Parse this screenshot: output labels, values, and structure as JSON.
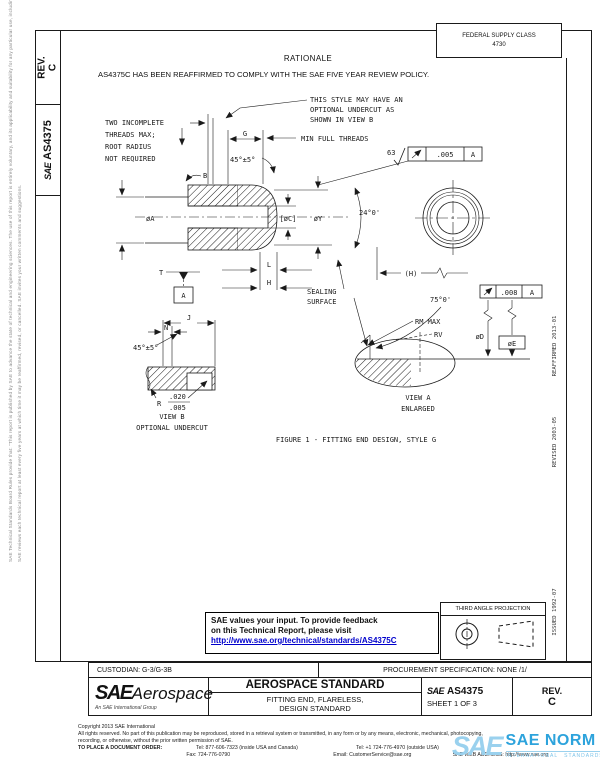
{
  "header": {
    "rev_label": "REV.",
    "rev_value": "C",
    "doc_logo": "SAE",
    "doc_number": "AS4375",
    "fsc_line1": "FEDERAL SUPPLY CLASS",
    "fsc_line2": "4730"
  },
  "rationale": {
    "title": "RATIONALE",
    "body": "AS4375C HAS BEEN REAFFIRMED TO COMPLY WITH THE SAE FIVE YEAR REVIEW POLICY."
  },
  "drawing": {
    "caption": "FIGURE 1 - FITTING END DESIGN, STYLE G",
    "note_style": [
      "THIS STYLE MAY HAVE AN",
      "OPTIONAL UNDERCUT AS",
      "SHOWN IN VIEW B"
    ],
    "note_threads": [
      "TWO INCOMPLETE",
      "THREADS MAX;",
      "ROOT RADIUS",
      "NOT REQUIRED"
    ],
    "sealing": [
      "SEALING",
      "SURFACE"
    ],
    "view_a": [
      "VIEW A",
      "ENLARGED"
    ],
    "view_b": [
      "VIEW B",
      "OPTIONAL UNDERCUT"
    ],
    "labels": {
      "g": "G",
      "min_full_threads": "MIN FULL THREADS",
      "chamfer_top": "45°±5°",
      "finish": "63",
      "fcf_top_val": ".005",
      "fcf_top_datum": "A",
      "b": "B",
      "dia_a": "øA",
      "dia_c": "[øC]",
      "dia_y": "øY",
      "cone_angle": "24°0'",
      "dim_h_ref": "(H)",
      "dim_l": "L",
      "dim_h": "H",
      "datum_t": "T",
      "datum_a": "A",
      "seat_angle": "75°0'",
      "fcf_seat_val": ".008",
      "fcf_seat_datum": "A",
      "rm_max": "RM MAX",
      "rv": "RV",
      "dia_d": "øD",
      "dia_e": "øE",
      "dim_j": "J",
      "dim_n": "N",
      "chamfer_b": "45°±5°",
      "r_label": "R",
      "r_max": ".020",
      "r_min": ".005"
    }
  },
  "margins": {
    "left_note1": "SAE Technical Standards Board Rules provide that: \"This report is published by SAE to advance the state of technical and engineering sciences. The use of this report is entirely voluntary, and its applicability and suitability for any particular use, including any patent infringement arising therefrom, is the sole responsibility of the user.\"",
    "left_note2": "SAE reviews each technical report at least every five years at which time it may be reaffirmed, revised, or cancelled. SAE invites your written comments and suggestions.",
    "reaffirmed": "REAFFIRMED 2013-01",
    "revised": "REVISED 2003-05",
    "issued": "ISSUED 1992-07"
  },
  "feedback": {
    "line1": "SAE values your input. To provide feedback",
    "line2": "on this Technical Report, please visit",
    "link": "http://www.sae.org/technical/standards/AS4375C"
  },
  "projection": {
    "title": "THIRD ANGLE PROJECTION"
  },
  "titleblock": {
    "custodian": "CUSTODIAN: G-3/G-3B",
    "procurement": "PROCUREMENT SPECIFICATION: NONE /1/",
    "org": "SAE",
    "org2": "Aerospace",
    "tagline": "An SAE International Group",
    "doc_type": "AEROSPACE STANDARD",
    "title1": "FITTING END, FLARELESS,",
    "title2": "DESIGN STANDARD",
    "num_prefix": "SAE",
    "number": "AS4375",
    "sheet": "SHEET 1 OF 3",
    "rev_label": "REV.",
    "rev_value": "C"
  },
  "footer": {
    "copyright": "Copyright 2013 SAE International",
    "rights1": "All rights reserved. No part of this publication may be reproduced, stored in a retrieval system or transmitted, in any form or by any means, electronic, mechanical, photocopying,",
    "rights2": "recording, or otherwise, without the prior written permission of SAE.",
    "order_label": "TO PLACE A DOCUMENT ORDER:",
    "tel1": "Tel: 877-606-7323 (inside USA and Canada)",
    "tel2": "Tel: +1 724-776-4970 (outside USA)",
    "fax": "Fax: 724-776-0790",
    "email": "Email: CustomerService@sae.org",
    "web": "SAE WEB ADDRESS: http://www.sae.org"
  },
  "watermark": {
    "logo": "SAE",
    "name": "SAE NORM",
    "sub1": "INTERNATIONAL",
    "sub2": "STANDARDS"
  },
  "colors": {
    "link": "#0000cc",
    "line": "#1a1a1a",
    "watermark": "#2da3dc"
  }
}
